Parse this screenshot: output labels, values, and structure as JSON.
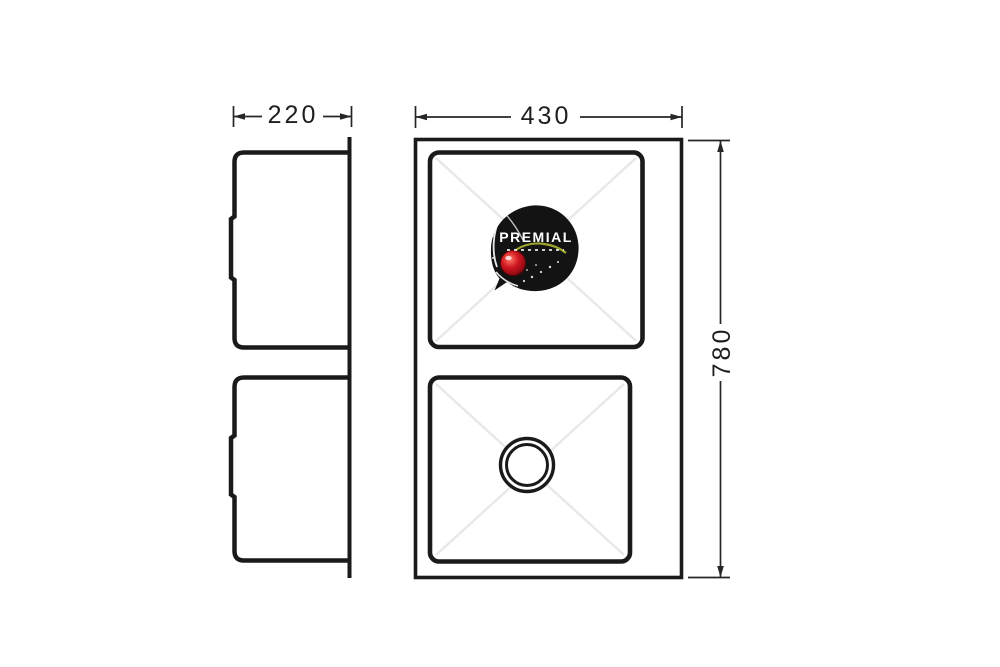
{
  "drawing": {
    "dimensions": {
      "depth_mm": "220",
      "width_mm": "430",
      "height_mm": "780"
    },
    "logo": {
      "brand": "PREMIAL"
    },
    "colors": {
      "background": "#ffffff",
      "outline": "#1a1a1a",
      "dimension_line": "#262626",
      "faint_crease": "#e8e8e8",
      "badge": "#131313",
      "cherry": "#d01620",
      "stem": "#9fa42e",
      "badge_text": "#ffffff"
    }
  }
}
